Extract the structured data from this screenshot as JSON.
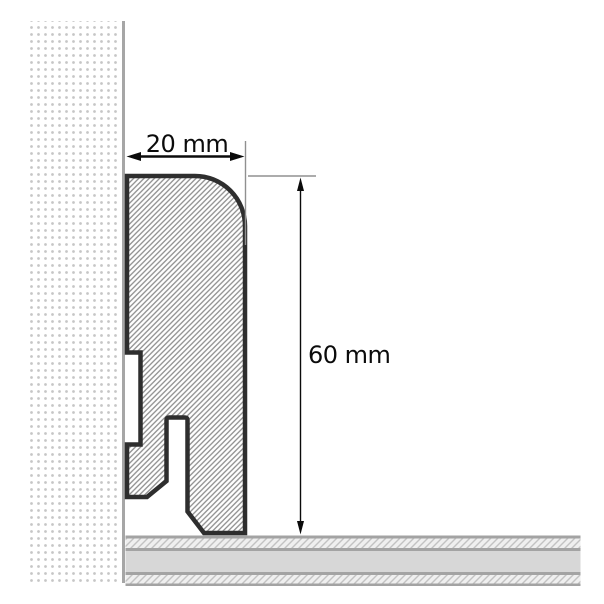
{
  "diagram": {
    "dimension_width": {
      "label": "20 mm",
      "value": 20,
      "unit": "mm"
    },
    "dimension_height": {
      "label": "60 mm",
      "value": 60,
      "unit": "mm"
    },
    "colors": {
      "background": "#ffffff",
      "profile_outline": "#2e2e2e",
      "profile_hatch": "#8e8e8e",
      "wall_dots": "#c6c6c6",
      "wall_edge": "#a6a6a6",
      "floor_border": "#a3a3a3",
      "floor_solid": "#d7d7d7",
      "floor_hatch_line": "#c2c2c2",
      "floor_hatch_bg": "#efefef",
      "dimension_ink": "#0b0b0b",
      "extension_line": "#909090"
    }
  }
}
